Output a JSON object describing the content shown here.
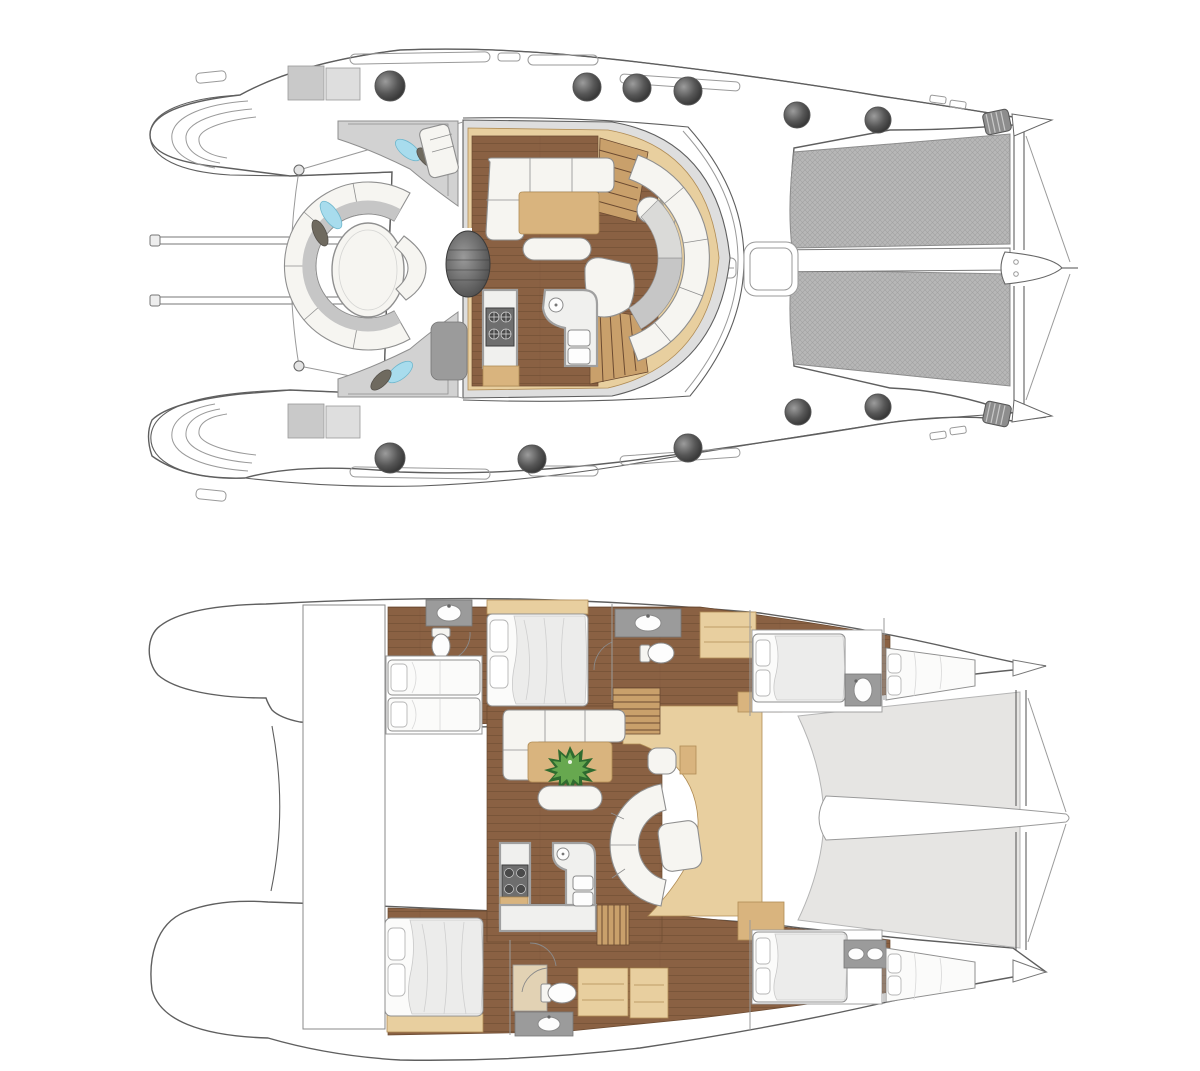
{
  "diagram": {
    "type": "catamaran-floor-plan",
    "views": [
      {
        "id": "upper-deck",
        "label": "Main deck plan: aft cockpit, salon, galley and foredeck trampolines"
      },
      {
        "id": "lower-deck",
        "label": "Accommodation plan: hull cabins, bathrooms, salon, galley and forward netting"
      }
    ],
    "features": {
      "portholes_upper_view": 11,
      "trampolines": 2,
      "cabins_lower_view": 6,
      "bathrooms_lower_view": 4
    }
  },
  "colors": {
    "paper": "#ffffff",
    "line": "#5f5f5f",
    "lineSoft": "#9a9a9a",
    "hull": "#ffffff",
    "wall": "#dedede",
    "tramp": "#b7b7b7",
    "trampLine": "#989898",
    "wood": "#8a6143",
    "woodLine": "#6b4a31",
    "woodLight": "#c9a06b",
    "tan": "#e8cf9f",
    "tanDark": "#d9b47e",
    "tanLine": "#b08c55",
    "furnWhite": "#f6f5f1",
    "furnStroke": "#8f8f8f",
    "cushionGray": "#c6c6c6",
    "cushionDark": "#9b9b9b",
    "benchGray": "#d2d2d2",
    "pillowBlue": "#a8dced",
    "pillowOlive": "#6f6a5f",
    "counterWhite": "#f0f0ee",
    "counterGray": "#a0a0a0",
    "stoveDark": "#6e6e6e",
    "burner": "#4a4a4a",
    "grayArea": "#e6e5e3",
    "grayAreaLine": "#b5b5b5",
    "plantDark": "#2f6b2f",
    "plantLight": "#67a84f",
    "bedWhite": "#fbfbfa",
    "duvet": "#ececeb",
    "duvetLine": "#c9c9c9",
    "sinkWhite": "#fdfdfd"
  }
}
